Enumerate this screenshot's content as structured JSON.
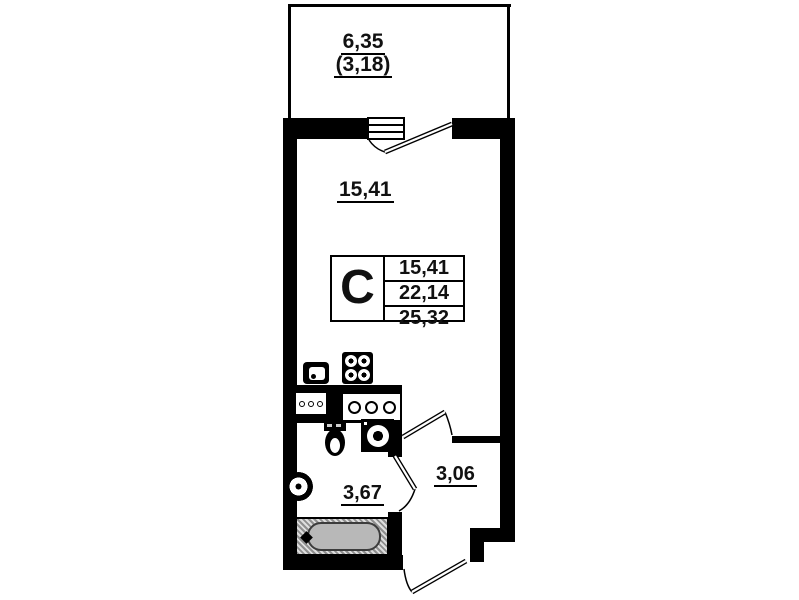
{
  "colors": {
    "wall": "#000000",
    "background": "#ffffff",
    "tub_fill": "#b8b8b8"
  },
  "labels": {
    "balcony_area": "6,35",
    "balcony_area_coeff": "(3,18)",
    "room_area": "15,41",
    "bathroom_area": "3,67",
    "hall_area": "3,06"
  },
  "info_box": {
    "apartment_type": "С",
    "living_area": "15,41",
    "area_without_balcony": "22,14",
    "total_area": "25,32"
  }
}
